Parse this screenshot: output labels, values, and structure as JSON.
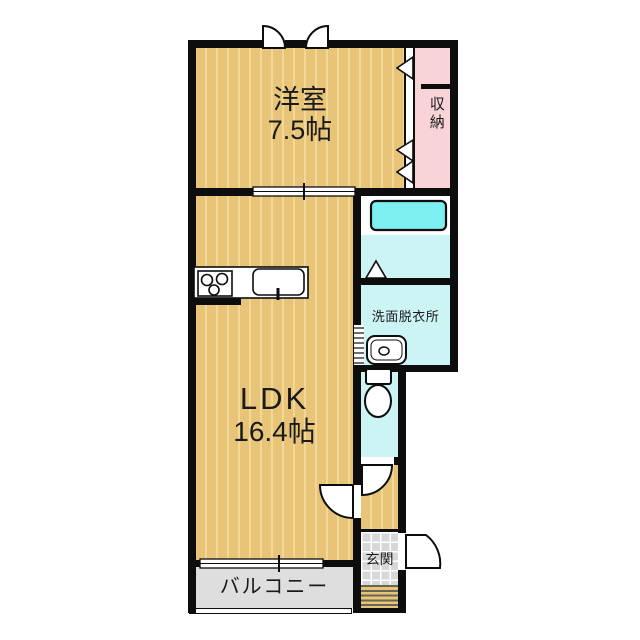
{
  "document": {
    "type": "floor-plan",
    "layout_name": "1LDK apartment"
  },
  "colors": {
    "paper": "#ffffff",
    "ink": "#1a1a1a",
    "wall": "#0d0d0d",
    "floor": "#e8c478",
    "stripe": "#f2d896",
    "closet": "#f8d3d8",
    "tub": "#7deff0",
    "wet": "#cdf4f5",
    "balcony": "#dedede",
    "tile": "#d7d7d7",
    "stepline": "#666655"
  },
  "rooms": {
    "western_room": {
      "name": "洋室",
      "area": "7.5帖"
    },
    "ldk": {
      "name": "LDK",
      "area": "16.4帖"
    },
    "closet": {
      "name": "収納"
    },
    "washroom": {
      "name": "洗面脱衣所"
    },
    "entrance": {
      "name": "玄関"
    },
    "balcony": {
      "name": "バルコニー"
    }
  },
  "icons": {
    "bathtub": "rounded-rectangle-tub",
    "bath_door": "up-pointing-triangle-fold-door",
    "washbasin": "rounded-basin-with-drain-circle",
    "toilet": "tank-and-bowl",
    "stove": "three-burner-cooktop",
    "kitchen_sink": "rounded-sink-with-faucet",
    "closet_door": "folding-door-triangles",
    "entry_door": "outward-quarter-swing",
    "interior_door": "quarter-circle-swing",
    "sliding_window": "double-line-with-center-tick"
  }
}
